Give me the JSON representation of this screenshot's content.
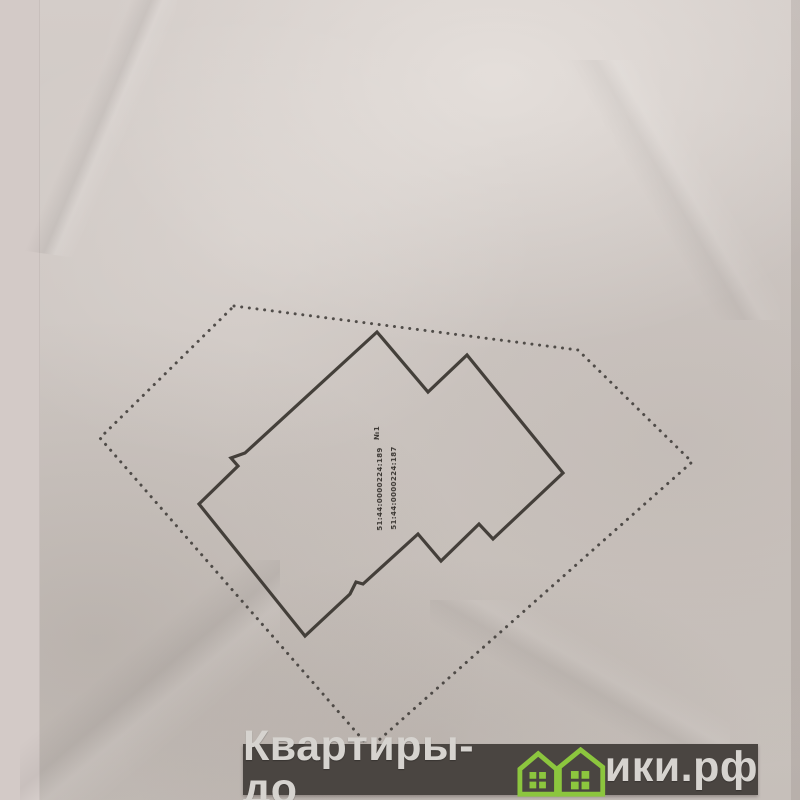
{
  "plan": {
    "line_color": "#38342f",
    "boundary_dot_color": "#3f3b38",
    "parcel_boundary": {
      "style": "dotted",
      "points": [
        [
          234,
          306
        ],
        [
          578,
          350
        ],
        [
          692,
          462
        ],
        [
          370,
          748
        ],
        [
          100,
          438
        ]
      ]
    },
    "building_outline": {
      "style": "solid",
      "points": [
        [
          377,
          332
        ],
        [
          428,
          392
        ],
        [
          467,
          355
        ],
        [
          563,
          473
        ],
        [
          493,
          539
        ],
        [
          479,
          524
        ],
        [
          441,
          561
        ],
        [
          418,
          534
        ],
        [
          363,
          584
        ],
        [
          356,
          582
        ],
        [
          350,
          594
        ],
        [
          305,
          636
        ],
        [
          199,
          504
        ],
        [
          238,
          466
        ],
        [
          231,
          458
        ],
        [
          245,
          453
        ]
      ]
    },
    "labels": {
      "mark": "№1",
      "cadastral_1": "51:44:0000224:189",
      "cadastral_2": "51:44:0000224:187"
    }
  },
  "watermark": {
    "full_text": "Квартиры-домики.рф",
    "text_before_icon": "Квартиры-до",
    "text_after_icon": "ики.рф",
    "bar_color": "#4a4541",
    "text_color": "#d6d3cf",
    "house_color": "#8cc63e",
    "icon": "green-house-icons"
  }
}
